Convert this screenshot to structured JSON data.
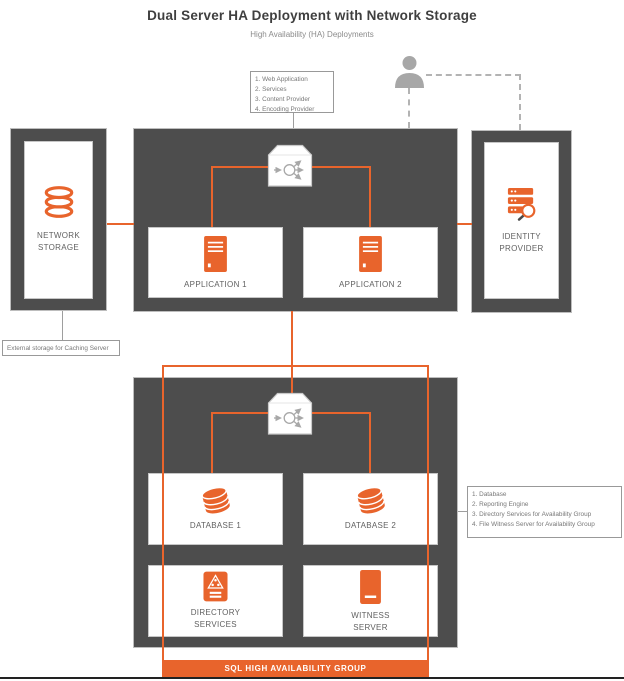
{
  "title": "Dual Server HA Deployment with Network Storage",
  "subtitle": "High Availability (HA) Deployments",
  "colors": {
    "accent_orange": "#E8642C",
    "node_dark": "#4D4D4D",
    "connector_gray": "#9E9E9E",
    "user_gray": "#A7A7A7"
  },
  "annotations": {
    "app_services": {
      "lines": [
        "1. Web Application",
        "2. Services",
        "3. Content Provider",
        "4. Encoding Provider"
      ]
    },
    "external_storage": {
      "text": "External storage for Caching Server"
    },
    "database_services": {
      "lines": [
        "1. Database",
        "2. Reporting Engine",
        "3. Directory Services for Availability Group",
        "4. File Witness Server for Availability Group"
      ]
    }
  },
  "nodes": {
    "network_storage": {
      "label": "NETWORK STORAGE",
      "icon": "storage-disks-icon"
    },
    "identity_provider": {
      "label": "IDENTITY PROVIDER",
      "icon": "server-search-icon"
    },
    "application1": {
      "label": "APPLICATION 1",
      "icon": "server-tower-icon"
    },
    "application2": {
      "label": "APPLICATION 2",
      "icon": "server-tower-icon"
    },
    "database1": {
      "label": "DATABASE 1",
      "icon": "database-cylinder-icon"
    },
    "database2": {
      "label": "DATABASE 2",
      "icon": "database-cylinder-icon"
    },
    "directory_services": {
      "label": "DIRECTORY SERVICES",
      "icon": "directory-tree-icon"
    },
    "witness_server": {
      "label": "WITNESS SERVER",
      "icon": "witness-server-icon"
    },
    "load_balancer_top": {
      "icon": "load-balancer-icon"
    },
    "load_balancer_bottom": {
      "icon": "load-balancer-icon"
    },
    "user": {
      "icon": "person-icon"
    }
  },
  "group_label": "SQL HIGH AVAILABILITY GROUP"
}
